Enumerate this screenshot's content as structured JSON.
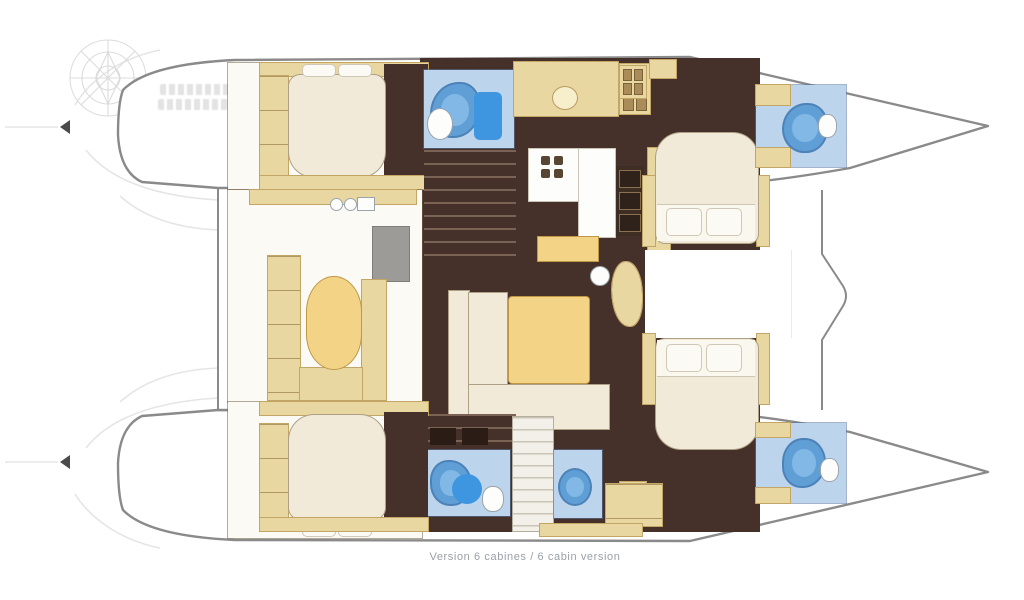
{
  "caption": "Version 6 cabines / 6 cabin version",
  "palette": {
    "floor-dark": "#46302a",
    "wood-tan": "#e9d7a2",
    "wood-tan-border": "#c3a565",
    "table-yellow": "#f3d487",
    "bed-cream": "#f1ead8",
    "room-white": "#fbfaf5",
    "bath-blue": "#bdd5ec",
    "shower-blue": "#5f9fd6",
    "shower-bright": "#3e96e0",
    "outline-gray": "#8a8a8a",
    "ghost-gray": "#dcdcdc",
    "caption-gray": "#9aa0a6"
  },
  "icons": {
    "shower": "shower-icon",
    "toilet": "toilet-icon",
    "sink": "sink-icon",
    "stove": "stove-burner-icon",
    "compass_watermark": "compass-rose-icon",
    "transom_arrow": "left-arrow-icon"
  }
}
